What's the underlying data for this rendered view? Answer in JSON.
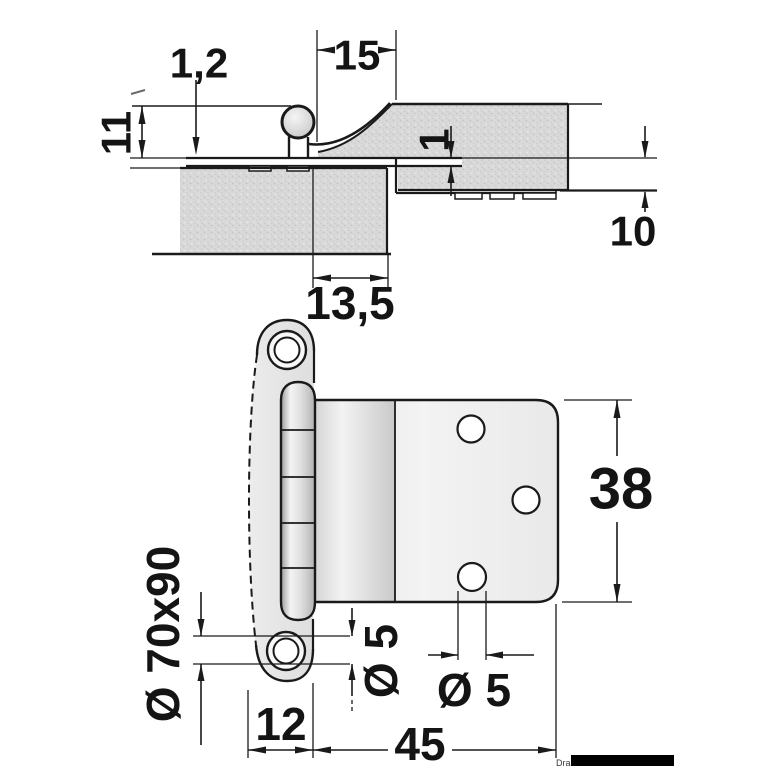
{
  "drawing": {
    "kind": "technical dimension drawing",
    "subject": "semi-recessed cabinet hinge, cross-section view (top) and front view (bottom)"
  },
  "section_view": {
    "labels": {
      "leaf_thickness": "1,2",
      "knuckle_offset": "15",
      "frame_thickness": "11",
      "recess_depth": "1",
      "door_depth": "10",
      "edge_distance": "13,5"
    }
  },
  "front_view": {
    "labels": {
      "plate_height": "38",
      "wing_size": "Ø 70x90",
      "wing_hole_diameter": "Ø 5",
      "wing_width": "12",
      "plate_width": "45",
      "plate_hole_diameter": "Ø 5"
    }
  },
  "watermark": {
    "text": "Dra"
  },
  "colors": {
    "line": "#1a1a1a",
    "panel_fill": "#d9d9d9",
    "metal_light": "#f2f2f2",
    "metal_dark": "#9c9c9c"
  }
}
